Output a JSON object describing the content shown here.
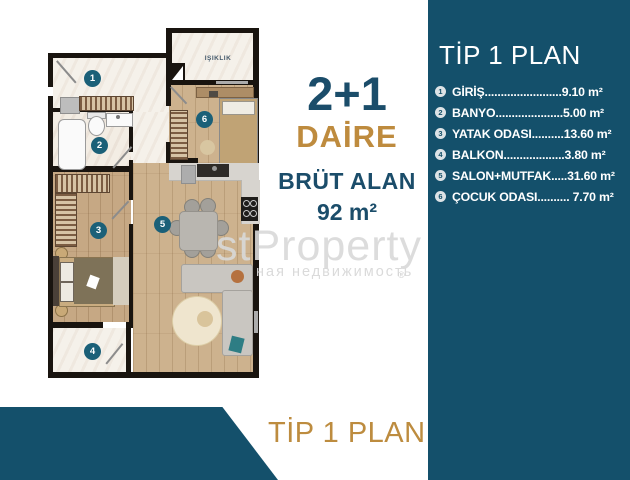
{
  "colors": {
    "teal_panel": "#14506B",
    "gold": "#BE8B3E",
    "navy_text": "#1B4D6A",
    "marker_teal": "#1B6078"
  },
  "plan": {
    "skylight_label": "IŞIKLIK",
    "markers": [
      "1",
      "2",
      "3",
      "4",
      "5",
      "6"
    ]
  },
  "center": {
    "config": "2+1",
    "type_label": "DAİRE",
    "gross_label": "BRÜT ALAN",
    "gross_value": "92 m²"
  },
  "sidebar": {
    "title": "TİP 1 PLAN",
    "items": [
      {
        "num": "1",
        "label": "GİRİŞ",
        "dots": "........................",
        "value": "9.10 m²"
      },
      {
        "num": "2",
        "label": "BANYO",
        "dots": ".....................",
        "value": "5.00 m²"
      },
      {
        "num": "3",
        "label": "YATAK ODASI",
        "dots": "..........",
        "value": "13.60 m²"
      },
      {
        "num": "4",
        "label": "BALKON",
        "dots": "...................",
        "value": "3.80 m²"
      },
      {
        "num": "5",
        "label": "SALON+MUTFAK",
        "dots": ".....",
        "value": "31.60 m²"
      },
      {
        "num": "6",
        "label": "ÇOCUK ODASI",
        "dots": "..........",
        "value": " 7.70 m²"
      }
    ]
  },
  "footer": {
    "title": "TİP 1 PLAN"
  },
  "watermark": {
    "main": "stProperty",
    "sub": "ная недвижимость",
    "reg": "®"
  }
}
